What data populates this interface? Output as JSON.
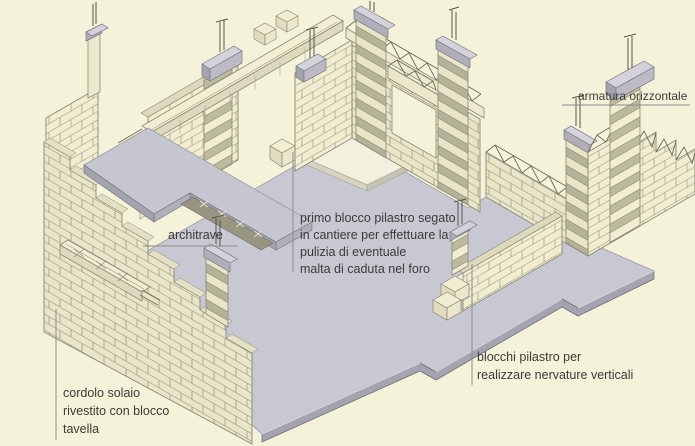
{
  "title": "Isometric masonry construction diagram (reinforced block walls on floor slab)",
  "language": "it",
  "colors": {
    "background": "#f5f2da",
    "floor_top": "#c8c8d3",
    "floor_side": "#a4a4b0",
    "slab_gray": "#c6c6d1",
    "brick_light": "#f0edd1",
    "brick_shaded": "#e8e5c9",
    "brick_band_dark": "#bcbb9f",
    "outline": "#8a8876",
    "truss": "#6b6a58",
    "text": "#3b3b38",
    "leader_line": "#8c8c8c"
  },
  "labels": {
    "armatura_orizzontale": {
      "text": "armatura orizzontale"
    },
    "architrave": {
      "text": "architrave"
    },
    "primo_blocco": {
      "lines": [
        "primo blocco pilastro segato",
        "in cantiere per effettuare la",
        "pulizia di eventuale",
        "malta di caduta nel foro"
      ]
    },
    "blocchi_pilastro": {
      "lines": [
        "blocchi pilastro per",
        "realizzare nervature verticali"
      ]
    },
    "cordolo_solaio": {
      "lines": [
        "cordolo solaio",
        "rivestito con blocco",
        "tavella"
      ]
    }
  }
}
